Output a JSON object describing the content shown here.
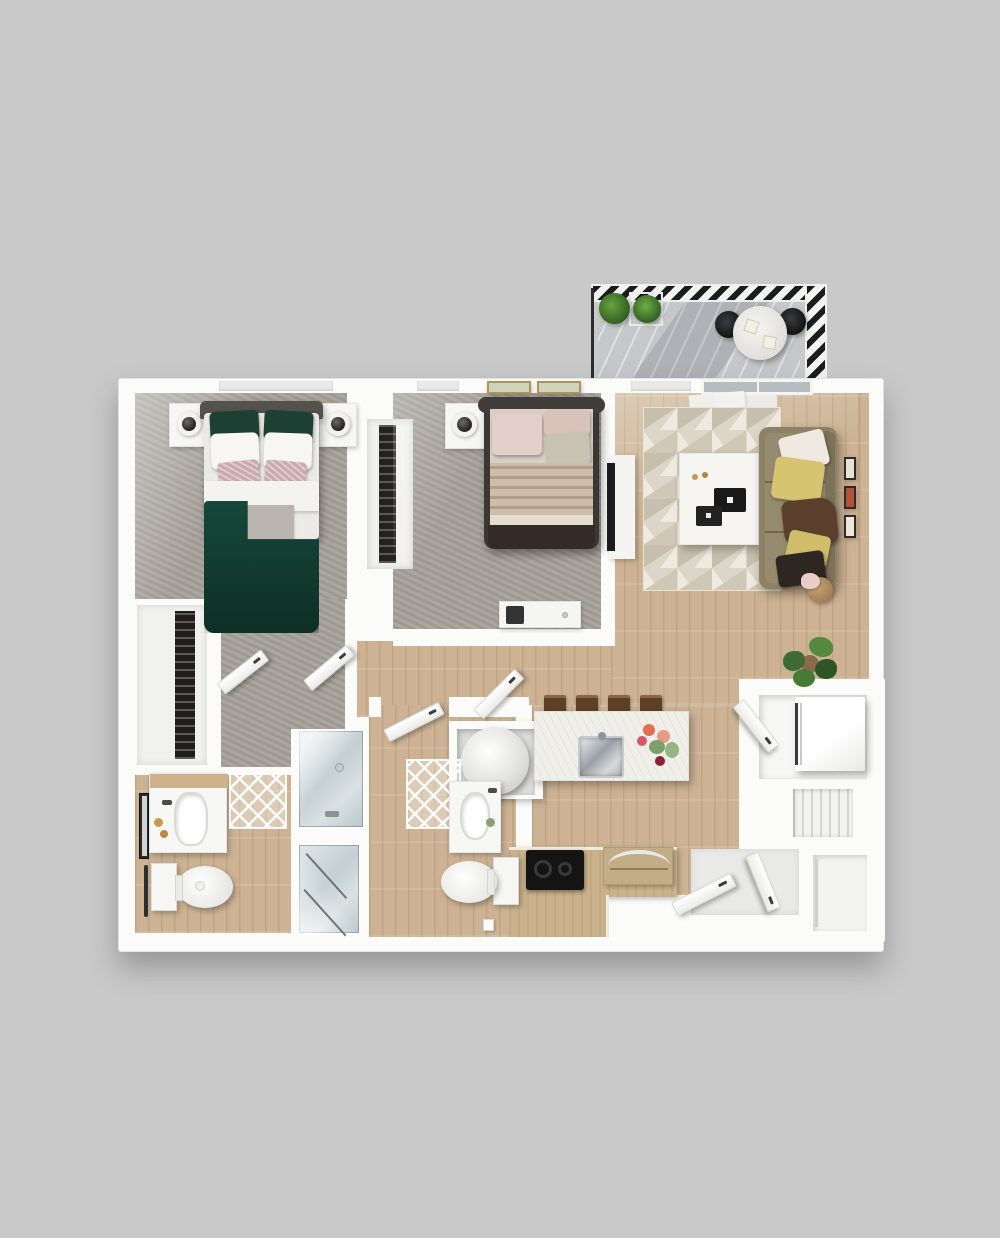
{
  "scene": {
    "type": "3d-floorplan-top-down-render",
    "unit_type": "two-bedroom-two-bath-apartment-with-balcony",
    "background_color": "#c9c9c9",
    "wall_color": "#fbfbf9"
  },
  "palette": {
    "carpet_gray": "#a7a19b",
    "wood_floor_tan": "#cdb394",
    "rug_cream": "#dcd6c8",
    "rug_triangle_dark": "#c6bfad",
    "rug_triangle_light": "#efeae0",
    "duvet_green": "#123a2f",
    "sofa_olive": "#8d8266",
    "pillow_yellow": "#d6c470",
    "pillow_brown": "#5a3f2c",
    "counter_tan": "#c9b28c",
    "cooktop_black": "#141414",
    "shower_glass": "#ccd6d9",
    "railing_black": "#1a1c1e",
    "deck_gray": "#c5c7ca",
    "entry_floor": "#e9e9e7",
    "bed2_frame": "#3b3734",
    "blanket_tan": "#cdbda9"
  },
  "rooms": {
    "balcony": {
      "name": "Balcony",
      "items": [
        "hatched railing",
        "plank deck",
        "two potted plants",
        "round bistro table",
        "two chairs",
        "two place settings",
        "door mat"
      ]
    },
    "living": {
      "name": "Living Room",
      "items": [
        "sliding glass door",
        "geometric triangle rug",
        "white coffee table",
        "olive sofa with five pillows",
        "tv on media console",
        "three wall frames",
        "round side table",
        "fiddle leaf plant"
      ]
    },
    "bedroom1": {
      "name": "Bedroom 1",
      "items": [
        "double bed with green duvet",
        "two nightstands with lamps",
        "windows",
        "walk-in closet with hanging clothes"
      ]
    },
    "bedroom2": {
      "name": "Bedroom 2",
      "items": [
        "double bed with tan striped blanket",
        "nightstand with lamp",
        "two picture frames",
        "white dresser",
        "closet with hanging clothes"
      ]
    },
    "kitchen": {
      "name": "Kitchen",
      "items": [
        "island with chrome sink and flowers",
        "four bar stools",
        "black cooktop",
        "appliance with curved chrome handle",
        "base cabinet run",
        "utility closet with round water heater"
      ]
    },
    "bathroom1": {
      "name": "Bathroom 1",
      "items": [
        "vanity with sink",
        "wall mirror",
        "toilet",
        "towel bar",
        "diamond bath mat",
        "glass shower"
      ]
    },
    "bathroom2": {
      "name": "Bathroom 2",
      "items": [
        "vanity with sink",
        "toilet",
        "diamond bath mat",
        "glass shower"
      ]
    },
    "laundry": {
      "name": "Laundry Closet",
      "items": [
        "white washer dryer unit",
        "closet door"
      ]
    },
    "entry": {
      "name": "Entry",
      "items": [
        "entry door",
        "second door leaf",
        "coat closet",
        "louvered closet"
      ]
    }
  }
}
